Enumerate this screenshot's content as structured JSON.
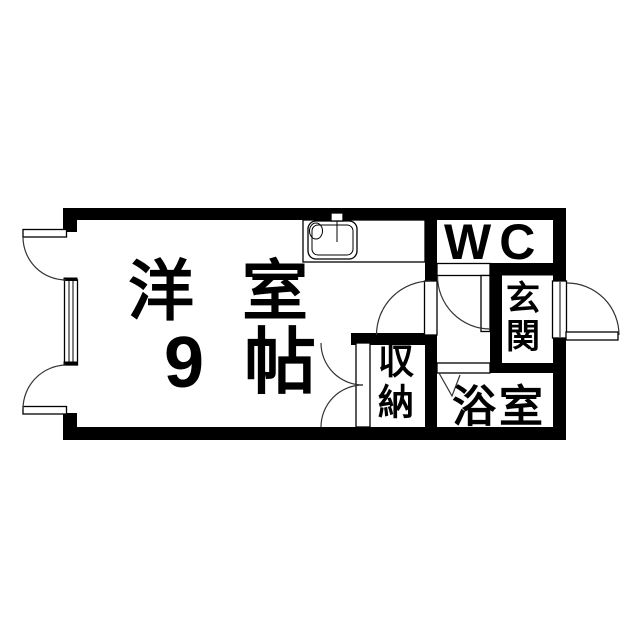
{
  "colors": {
    "wall": "#000000",
    "line": "#333333",
    "background": "#ffffff"
  },
  "rooms": {
    "main": {
      "name": "洋室",
      "size": "9帖"
    },
    "wc": {
      "label": "WC"
    },
    "entrance": {
      "label": "玄関"
    },
    "storage": {
      "label": "収納"
    },
    "bath": {
      "label": "浴室"
    }
  },
  "fixtures": [
    {
      "icon": "kitchen-sink-icon"
    },
    {
      "icon": "casement-window-icon"
    },
    {
      "icon": "hinged-door-icon"
    },
    {
      "icon": "folding-door-icon"
    },
    {
      "icon": "double-closet-door-icon"
    }
  ]
}
